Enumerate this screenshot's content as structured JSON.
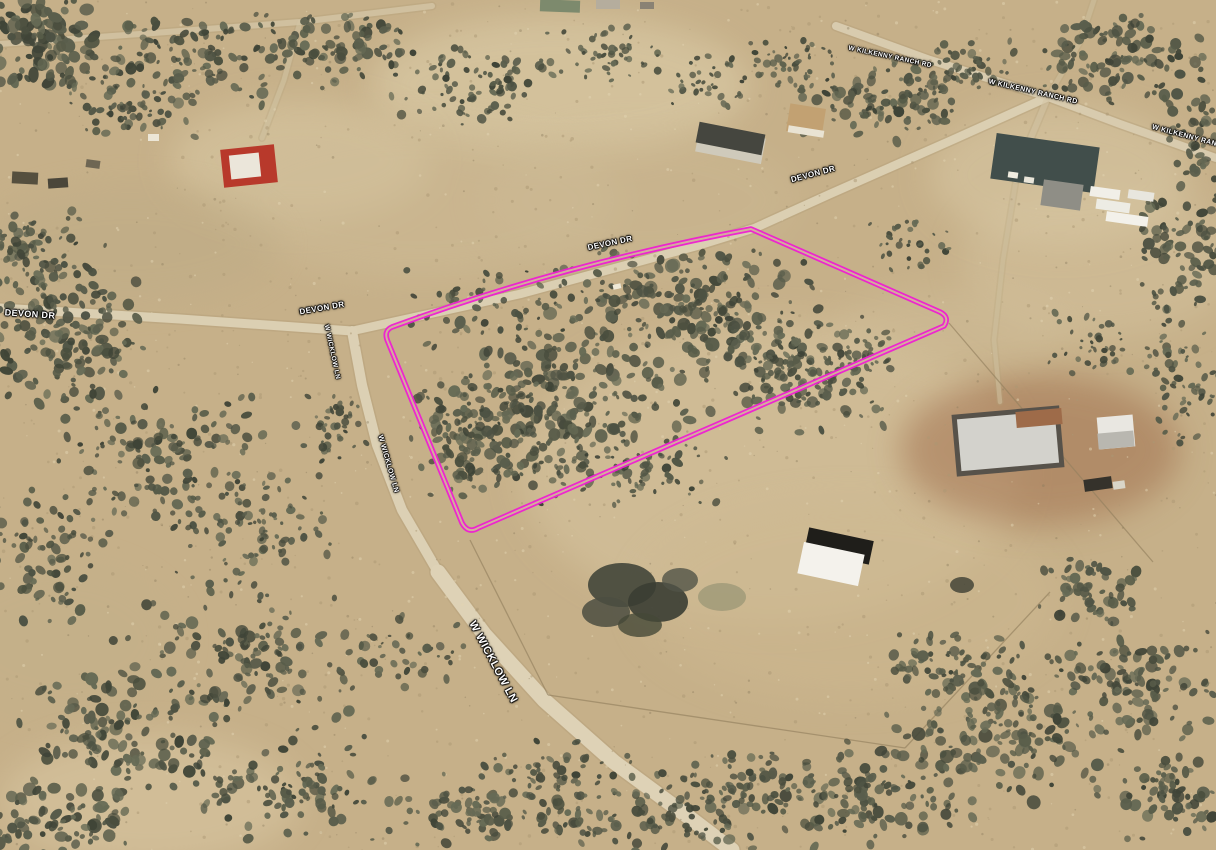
{
  "view": {
    "type": "aerial-satellite-oblique",
    "width": 1216,
    "height": 850,
    "base_color": "#c6b089"
  },
  "parcel": {
    "outline_color": "#ee1fd2",
    "gap_color": "#d0bc97",
    "path": "M 751,229 L 940,312 Q 950,317 944,326 L 478,528 Q 468,534 462,523 L 388,342 Q 383,331 392,327 Q 560,265 751,229 Z"
  },
  "labels": [
    {
      "t": "DEVON DR",
      "x": 30,
      "y": 314,
      "r": 4,
      "s": 9
    },
    {
      "t": "DEVON DR",
      "x": 322,
      "y": 308,
      "r": -10,
      "s": 8
    },
    {
      "t": "DEVON DR",
      "x": 610,
      "y": 243,
      "r": -12,
      "s": 8
    },
    {
      "t": "DEVON DR",
      "x": 813,
      "y": 174,
      "r": -15,
      "s": 8
    },
    {
      "t": "W WICKLOW LN",
      "x": 332,
      "y": 352,
      "r": 78,
      "s": 6.5
    },
    {
      "t": "W WICKLOW LN",
      "x": 388,
      "y": 464,
      "r": 74,
      "s": 7
    },
    {
      "t": "W WICKLOW LN",
      "x": 493,
      "y": 662,
      "r": 62,
      "s": 11
    },
    {
      "t": "W KILKENNY RANCH RD",
      "x": 890,
      "y": 57,
      "r": 12,
      "s": 6.5
    },
    {
      "t": "W KILKENNY RANCH RD",
      "x": 1033,
      "y": 92,
      "r": 13,
      "s": 7
    },
    {
      "t": "W KILKENNY RANCH RD",
      "x": 1196,
      "y": 139,
      "r": 15,
      "s": 7
    }
  ],
  "roads": [
    {
      "name": "devon-dr-west",
      "path": "M 0,308 L 180,319 L 352,331",
      "w": 9,
      "c": "#dbcfb2",
      "o": 1
    },
    {
      "name": "devon-dr-east",
      "path": "M 352,331 L 520,294 L 700,245 L 755,228 L 830,194 L 950,141 L 1048,97",
      "w": 8.5,
      "c": "#dbcfb2",
      "o": 1
    },
    {
      "name": "wicklow-ln-upper",
      "path": "M 352,331 L 362,385 L 377,445 L 402,510 L 438,572",
      "w": 10,
      "c": "#dcd0b4",
      "o": 1
    },
    {
      "name": "wicklow-ln-lower",
      "path": "M 438,572 L 484,634 L 544,700 L 614,762 L 690,818 L 732,850",
      "w": 15,
      "c": "#ded2b6",
      "o": 1
    },
    {
      "name": "kilkenny-ranch-rd",
      "path": "M 836,26 L 930,60 L 1048,97 L 1120,124 L 1216,158",
      "w": 8,
      "c": "#d8cbae",
      "o": 1
    },
    {
      "name": "top-left-track",
      "path": "M 0,44 L 140,34 L 300,22 L 432,6",
      "w": 6,
      "c": "#d4c6a6",
      "o": 0.8
    },
    {
      "name": "farm-drive",
      "path": "M 300,22 L 284,80 L 262,138",
      "w": 5,
      "c": "#d2c4a4",
      "o": 0.6
    },
    {
      "name": "complex-drive",
      "path": "M 1048,97 L 1030,140 L 1016,180",
      "w": 6,
      "c": "#d3c5a5",
      "o": 0.6
    },
    {
      "name": "house-drive",
      "path": "M 1016,180 L 1003,260 L 994,340 L 1000,402",
      "w": 4.5,
      "c": "#cfc1a0",
      "o": 0.55
    },
    {
      "name": "top-branch-track",
      "path": "M 1048,97 L 1080,42 L 1094,0",
      "w": 5,
      "c": "#d2c4a4",
      "o": 0.5
    }
  ],
  "terrain_patches": [
    {
      "x": 560,
      "y": 85,
      "rx": 190,
      "ry": 70,
      "c": "#d9c9a4",
      "o": 0.7
    },
    {
      "x": 300,
      "y": 160,
      "rx": 130,
      "ry": 60,
      "c": "#d8c7a2",
      "o": 0.6
    },
    {
      "x": 420,
      "y": 200,
      "rx": 200,
      "ry": 80,
      "c": "#cfbd98",
      "o": 0.45
    },
    {
      "x": 130,
      "y": 245,
      "rx": 150,
      "ry": 60,
      "c": "#bcaa85",
      "o": 0.4
    },
    {
      "x": 770,
      "y": 470,
      "rx": 250,
      "ry": 150,
      "c": "#d5c39e",
      "o": 0.6
    },
    {
      "x": 850,
      "y": 600,
      "rx": 210,
      "ry": 100,
      "c": "#cdb890",
      "o": 0.5
    },
    {
      "x": 1040,
      "y": 450,
      "rx": 140,
      "ry": 75,
      "c": "#9e6b49",
      "o": 0.5
    },
    {
      "x": 1100,
      "y": 260,
      "rx": 140,
      "ry": 80,
      "c": "#d4c29e",
      "o": 0.5
    },
    {
      "x": 1060,
      "y": 175,
      "rx": 130,
      "ry": 70,
      "c": "#d7c6a2",
      "o": 0.6
    },
    {
      "x": 150,
      "y": 800,
      "rx": 150,
      "ry": 65,
      "c": "#dccaa6",
      "o": 0.5
    },
    {
      "x": 640,
      "y": 200,
      "rx": 160,
      "ry": 70,
      "c": "#cdbb96",
      "o": 0.35
    },
    {
      "x": 60,
      "y": 640,
      "rx": 120,
      "ry": 80,
      "c": "#c3b08a",
      "o": 0.4
    },
    {
      "x": 950,
      "y": 330,
      "rx": 120,
      "ry": 40,
      "c": "#d2c09b",
      "o": 0.45
    }
  ],
  "vegetation": {
    "palette": [
      "#4d5243",
      "#5a5e4c",
      "#3f4437",
      "#666a55",
      "#4a4e3e",
      "#585c49"
    ],
    "clusters": [
      {
        "x": 560,
        "y": 400,
        "rx": 140,
        "ry": 95,
        "n": 240,
        "r0": 2,
        "r1": 7,
        "seed": 11
      },
      {
        "x": 700,
        "y": 315,
        "rx": 130,
        "ry": 75,
        "n": 200,
        "r0": 2,
        "r1": 7,
        "seed": 12
      },
      {
        "x": 800,
        "y": 370,
        "rx": 100,
        "ry": 65,
        "n": 150,
        "r0": 2,
        "r1": 6,
        "seed": 13
      },
      {
        "x": 480,
        "y": 435,
        "rx": 80,
        "ry": 65,
        "n": 120,
        "r0": 2,
        "r1": 6,
        "seed": 14
      },
      {
        "x": 525,
        "y": 300,
        "rx": 150,
        "ry": 40,
        "n": 70,
        "r0": 1.5,
        "r1": 5,
        "seed": 15
      },
      {
        "x": 620,
        "y": 470,
        "rx": 120,
        "ry": 40,
        "n": 80,
        "r0": 1.5,
        "r1": 5,
        "seed": 16
      },
      {
        "x": 60,
        "y": 330,
        "rx": 90,
        "ry": 90,
        "n": 160,
        "r0": 2,
        "r1": 7,
        "seed": 21
      },
      {
        "x": 160,
        "y": 455,
        "rx": 110,
        "ry": 85,
        "n": 140,
        "r0": 2,
        "r1": 6,
        "seed": 22
      },
      {
        "x": 255,
        "y": 525,
        "rx": 90,
        "ry": 55,
        "n": 90,
        "r0": 1.5,
        "r1": 5,
        "seed": 23
      },
      {
        "x": 40,
        "y": 565,
        "rx": 70,
        "ry": 80,
        "n": 80,
        "r0": 2,
        "r1": 6,
        "seed": 24
      },
      {
        "x": 30,
        "y": 255,
        "rx": 60,
        "ry": 55,
        "n": 70,
        "r0": 2,
        "r1": 6,
        "seed": 25
      },
      {
        "x": 330,
        "y": 430,
        "rx": 40,
        "ry": 45,
        "n": 40,
        "r0": 1.5,
        "r1": 4.5,
        "seed": 26
      },
      {
        "x": 40,
        "y": 45,
        "rx": 75,
        "ry": 55,
        "n": 110,
        "r0": 2.5,
        "r1": 8,
        "seed": 31
      },
      {
        "x": 185,
        "y": 60,
        "rx": 120,
        "ry": 50,
        "n": 110,
        "r0": 2,
        "r1": 6,
        "seed": 32
      },
      {
        "x": 335,
        "y": 45,
        "rx": 95,
        "ry": 45,
        "n": 85,
        "r0": 2,
        "r1": 6,
        "seed": 33
      },
      {
        "x": 120,
        "y": 110,
        "rx": 80,
        "ry": 35,
        "n": 60,
        "r0": 1.5,
        "r1": 5,
        "seed": 34
      },
      {
        "x": 470,
        "y": 85,
        "rx": 85,
        "ry": 45,
        "n": 80,
        "r0": 1.5,
        "r1": 5,
        "seed": 41
      },
      {
        "x": 605,
        "y": 55,
        "rx": 70,
        "ry": 35,
        "n": 50,
        "r0": 1.5,
        "r1": 4.5,
        "seed": 42
      },
      {
        "x": 700,
        "y": 80,
        "rx": 50,
        "ry": 30,
        "n": 35,
        "r0": 1.5,
        "r1": 4,
        "seed": 43
      },
      {
        "x": 880,
        "y": 100,
        "rx": 95,
        "ry": 45,
        "n": 100,
        "r0": 2,
        "r1": 6,
        "seed": 51
      },
      {
        "x": 965,
        "y": 70,
        "rx": 60,
        "ry": 35,
        "n": 60,
        "r0": 1.5,
        "r1": 5,
        "seed": 52
      },
      {
        "x": 1120,
        "y": 60,
        "rx": 95,
        "ry": 50,
        "n": 110,
        "r0": 2,
        "r1": 6.5,
        "seed": 53
      },
      {
        "x": 1205,
        "y": 135,
        "rx": 40,
        "ry": 60,
        "n": 55,
        "r0": 2,
        "r1": 6,
        "seed": 54
      },
      {
        "x": 790,
        "y": 60,
        "rx": 50,
        "ry": 30,
        "n": 40,
        "r0": 1.5,
        "r1": 4.5,
        "seed": 55
      },
      {
        "x": 1180,
        "y": 255,
        "rx": 60,
        "ry": 80,
        "n": 85,
        "r0": 2,
        "r1": 6,
        "seed": 61
      },
      {
        "x": 1190,
        "y": 385,
        "rx": 50,
        "ry": 70,
        "n": 60,
        "r0": 1.5,
        "r1": 5,
        "seed": 62
      },
      {
        "x": 1100,
        "y": 345,
        "rx": 60,
        "ry": 35,
        "n": 40,
        "r0": 1.5,
        "r1": 4.5,
        "seed": 63
      },
      {
        "x": 905,
        "y": 245,
        "rx": 55,
        "ry": 28,
        "n": 32,
        "r0": 1.5,
        "r1": 4,
        "seed": 64
      },
      {
        "x": 860,
        "y": 360,
        "rx": 45,
        "ry": 28,
        "n": 30,
        "r0": 1.5,
        "r1": 4.5,
        "seed": 65
      },
      {
        "x": 250,
        "y": 655,
        "rx": 140,
        "ry": 80,
        "n": 130,
        "r0": 2,
        "r1": 6.5,
        "seed": 71
      },
      {
        "x": 120,
        "y": 735,
        "rx": 110,
        "ry": 70,
        "n": 120,
        "r0": 2,
        "r1": 7,
        "seed": 72
      },
      {
        "x": 60,
        "y": 815,
        "rx": 80,
        "ry": 45,
        "n": 80,
        "r0": 2.5,
        "r1": 7.5,
        "seed": 73
      },
      {
        "x": 300,
        "y": 785,
        "rx": 120,
        "ry": 60,
        "n": 100,
        "r0": 2,
        "r1": 6,
        "seed": 74
      },
      {
        "x": 480,
        "y": 805,
        "rx": 100,
        "ry": 45,
        "n": 80,
        "r0": 2,
        "r1": 6,
        "seed": 75
      },
      {
        "x": 650,
        "y": 820,
        "rx": 120,
        "ry": 38,
        "n": 90,
        "r0": 2,
        "r1": 6,
        "seed": 76
      },
      {
        "x": 855,
        "y": 795,
        "rx": 130,
        "ry": 55,
        "n": 130,
        "r0": 2,
        "r1": 6.5,
        "seed": 77
      },
      {
        "x": 1005,
        "y": 735,
        "rx": 120,
        "ry": 70,
        "n": 150,
        "r0": 2,
        "r1": 7,
        "seed": 78
      },
      {
        "x": 1135,
        "y": 685,
        "rx": 90,
        "ry": 60,
        "n": 110,
        "r0": 2,
        "r1": 6.5,
        "seed": 79
      },
      {
        "x": 1185,
        "y": 795,
        "rx": 80,
        "ry": 50,
        "n": 80,
        "r0": 2,
        "r1": 6.5,
        "seed": 80
      },
      {
        "x": 950,
        "y": 665,
        "rx": 80,
        "ry": 40,
        "n": 70,
        "r0": 2,
        "r1": 6,
        "seed": 81
      },
      {
        "x": 400,
        "y": 650,
        "rx": 80,
        "ry": 45,
        "n": 40,
        "r0": 1.5,
        "r1": 5,
        "seed": 82
      },
      {
        "x": 560,
        "y": 770,
        "rx": 90,
        "ry": 35,
        "n": 50,
        "r0": 1.5,
        "r1": 5,
        "seed": 83
      },
      {
        "x": 740,
        "y": 780,
        "rx": 90,
        "ry": 35,
        "n": 60,
        "r0": 1.5,
        "r1": 5,
        "seed": 84
      },
      {
        "x": 1090,
        "y": 590,
        "rx": 60,
        "ry": 40,
        "n": 55,
        "r0": 2,
        "r1": 6,
        "seed": 85
      }
    ],
    "speckles": [
      {
        "n": 800,
        "c": "#ab9873",
        "r0": 0.6,
        "r1": 1.8,
        "o": 0.5,
        "seed": 91
      },
      {
        "n": 450,
        "c": "#e2d4b2",
        "r0": 0.6,
        "r1": 1.6,
        "o": 0.5,
        "seed": 92
      },
      {
        "n": 250,
        "c": "#8a7b5c",
        "r0": 0.5,
        "r1": 1.4,
        "o": 0.4,
        "seed": 93
      }
    ]
  },
  "fences": [
    {
      "x1": 949,
      "y1": 323,
      "x2": 1153,
      "y2": 562
    },
    {
      "x1": 470,
      "y1": 540,
      "x2": 548,
      "y2": 695
    },
    {
      "x1": 548,
      "y1": 695,
      "x2": 905,
      "y2": 748
    },
    {
      "x1": 905,
      "y1": 748,
      "x2": 1050,
      "y2": 592
    }
  ],
  "buildings": [
    {
      "n": "farm-building-red-roof",
      "x": 222,
      "y": 147,
      "w": 54,
      "h": 38,
      "rot": -6,
      "f": "#b8392b"
    },
    {
      "n": "farm-building-white",
      "x": 230,
      "y": 154,
      "w": 30,
      "h": 24,
      "rot": -6,
      "f": "#ebe6da"
    },
    {
      "n": "farm-junk-1",
      "x": 12,
      "y": 172,
      "w": 26,
      "h": 12,
      "rot": 3,
      "f": "#554f3e"
    },
    {
      "n": "farm-junk-2",
      "x": 48,
      "y": 178,
      "w": 20,
      "h": 10,
      "rot": -4,
      "f": "#4a463a"
    },
    {
      "n": "farm-junk-3",
      "x": 86,
      "y": 160,
      "w": 14,
      "h": 8,
      "rot": 8,
      "f": "#6e6653"
    },
    {
      "n": "farm-car",
      "x": 148,
      "y": 134,
      "w": 11,
      "h": 7,
      "rot": 0,
      "f": "#ece6d6"
    },
    {
      "n": "green-roof-building",
      "x": 540,
      "y": 0,
      "w": 40,
      "h": 12,
      "rot": 2,
      "f": "#7d8a6d"
    },
    {
      "n": "top-shed-1",
      "x": 596,
      "y": 0,
      "w": 24,
      "h": 9,
      "rot": 0,
      "f": "#b5ad9d"
    },
    {
      "n": "top-shed-2",
      "x": 640,
      "y": 2,
      "w": 14,
      "h": 7,
      "rot": 0,
      "f": "#8a8274"
    },
    {
      "n": "long-barn-base",
      "x": 697,
      "y": 132,
      "w": 67,
      "h": 26,
      "rot": 11,
      "f": "#cfcabb"
    },
    {
      "n": "long-barn-roof",
      "x": 697,
      "y": 128,
      "w": 67,
      "h": 21,
      "rot": 11,
      "f": "#45463f"
    },
    {
      "n": "tan-building",
      "x": 788,
      "y": 106,
      "w": 36,
      "h": 28,
      "rot": 9,
      "f": "#c2a172"
    },
    {
      "n": "tan-building-edge",
      "x": 788,
      "y": 128,
      "w": 36,
      "h": 7,
      "rot": 9,
      "f": "#e9e3d3"
    },
    {
      "n": "complex-main-building",
      "x": 993,
      "y": 140,
      "w": 104,
      "h": 46,
      "rot": 8,
      "f": "#414e4b"
    },
    {
      "n": "complex-small-building",
      "x": 1042,
      "y": 182,
      "w": 40,
      "h": 26,
      "rot": 8,
      "f": "#8f8e86"
    },
    {
      "n": "trailer-1",
      "x": 1090,
      "y": 188,
      "w": 30,
      "h": 10,
      "rot": 8,
      "f": "#f1efe8"
    },
    {
      "n": "trailer-2",
      "x": 1096,
      "y": 201,
      "w": 34,
      "h": 10,
      "rot": 8,
      "f": "#edece4"
    },
    {
      "n": "trailer-3",
      "x": 1106,
      "y": 214,
      "w": 42,
      "h": 10,
      "rot": 8,
      "f": "#f3f1ea"
    },
    {
      "n": "trailer-4",
      "x": 1128,
      "y": 191,
      "w": 26,
      "h": 9,
      "rot": 8,
      "f": "#e8e6de"
    },
    {
      "n": "complex-car-1",
      "x": 1008,
      "y": 172,
      "w": 10,
      "h": 6,
      "rot": 8,
      "f": "#f0ece0"
    },
    {
      "n": "complex-car-2",
      "x": 1024,
      "y": 177,
      "w": 10,
      "h": 6,
      "rot": 8,
      "f": "#e9e5d9"
    },
    {
      "n": "house-outline",
      "x": 954,
      "y": 410,
      "w": 108,
      "h": 62,
      "rot": -5,
      "f": "#57524a"
    },
    {
      "n": "house-roof",
      "x": 959,
      "y": 415,
      "w": 98,
      "h": 52,
      "rot": -5,
      "f": "#d3d2cc"
    },
    {
      "n": "house-notch",
      "x": 1016,
      "y": 410,
      "w": 46,
      "h": 16,
      "rot": -5,
      "f": "#9e6b49"
    },
    {
      "n": "house-shed",
      "x": 1098,
      "y": 416,
      "w": 36,
      "h": 32,
      "rot": -5,
      "f": "#e9e7e1"
    },
    {
      "n": "house-shed-roof",
      "x": 1098,
      "y": 432,
      "w": 36,
      "h": 16,
      "rot": -5,
      "f": "#b9b7b0"
    },
    {
      "n": "house-car-dark",
      "x": 1084,
      "y": 478,
      "w": 28,
      "h": 12,
      "rot": -8,
      "f": "#35322b"
    },
    {
      "n": "house-car-white",
      "x": 1113,
      "y": 481,
      "w": 12,
      "h": 8,
      "rot": -8,
      "f": "#d9d5c8"
    },
    {
      "n": "gable-shed-dark-band",
      "x": 806,
      "y": 534,
      "w": 66,
      "h": 24,
      "rot": 12,
      "f": "#1f1e1a"
    },
    {
      "n": "gable-shed-white-roof",
      "x": 800,
      "y": 548,
      "w": 62,
      "h": 32,
      "rot": 12,
      "f": "#f4f2ec"
    },
    {
      "n": "car-on-devon-dr",
      "x": 613,
      "y": 284,
      "w": 8,
      "h": 5,
      "rot": -12,
      "f": "#efe9d7"
    }
  ],
  "ground_blobs": [
    {
      "x": 622,
      "y": 585,
      "rx": 34,
      "ry": 22,
      "f": "#43463a",
      "o": 0.9
    },
    {
      "x": 658,
      "y": 602,
      "rx": 30,
      "ry": 20,
      "f": "#3a3d33",
      "o": 0.9
    },
    {
      "x": 606,
      "y": 612,
      "rx": 24,
      "ry": 15,
      "f": "#4b4e41",
      "o": 0.85
    },
    {
      "x": 680,
      "y": 580,
      "rx": 18,
      "ry": 12,
      "f": "#515447",
      "o": 0.8
    },
    {
      "x": 640,
      "y": 625,
      "rx": 22,
      "ry": 12,
      "f": "#454837",
      "o": 0.8
    },
    {
      "x": 722,
      "y": 597,
      "rx": 24,
      "ry": 14,
      "f": "#7b8063",
      "o": 0.45
    },
    {
      "x": 962,
      "y": 585,
      "rx": 12,
      "ry": 8,
      "f": "#3c3f33",
      "o": 0.8
    }
  ]
}
